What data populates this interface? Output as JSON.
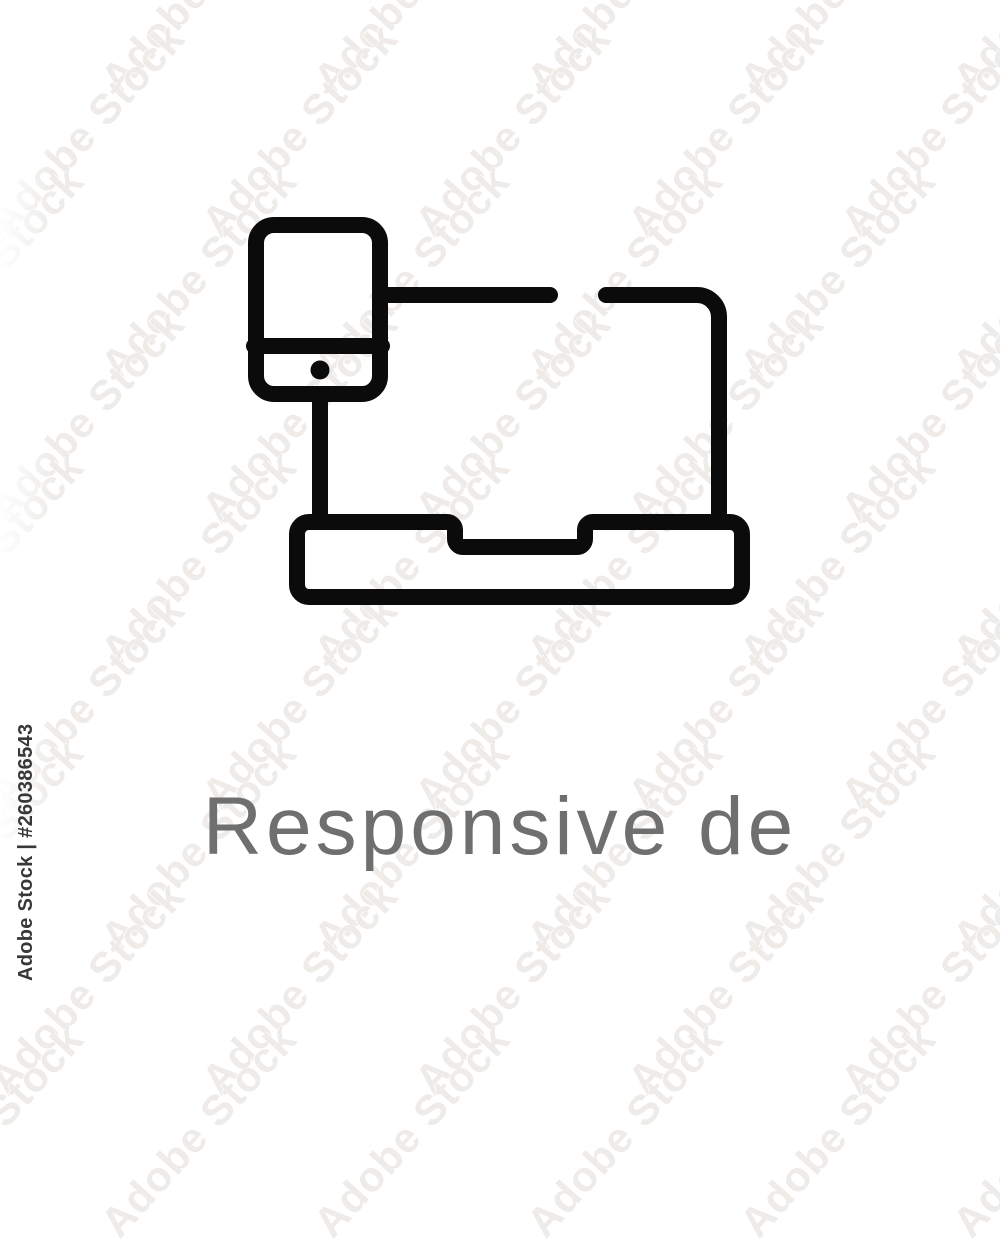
{
  "page": {
    "background_color": "#ffffff"
  },
  "watermark": {
    "tile_text": "Adobe Stock",
    "color": "#c6beb2"
  },
  "attribution": {
    "text": "Adobe Stock | #260386543",
    "color": "#383838"
  },
  "icon": {
    "name": "responsive-design-outline-icon",
    "parts": [
      "smartphone",
      "laptop"
    ],
    "stroke_color": "#0b0b0b"
  },
  "caption": {
    "text": "Responsive de",
    "color": "#6f6f6f"
  }
}
